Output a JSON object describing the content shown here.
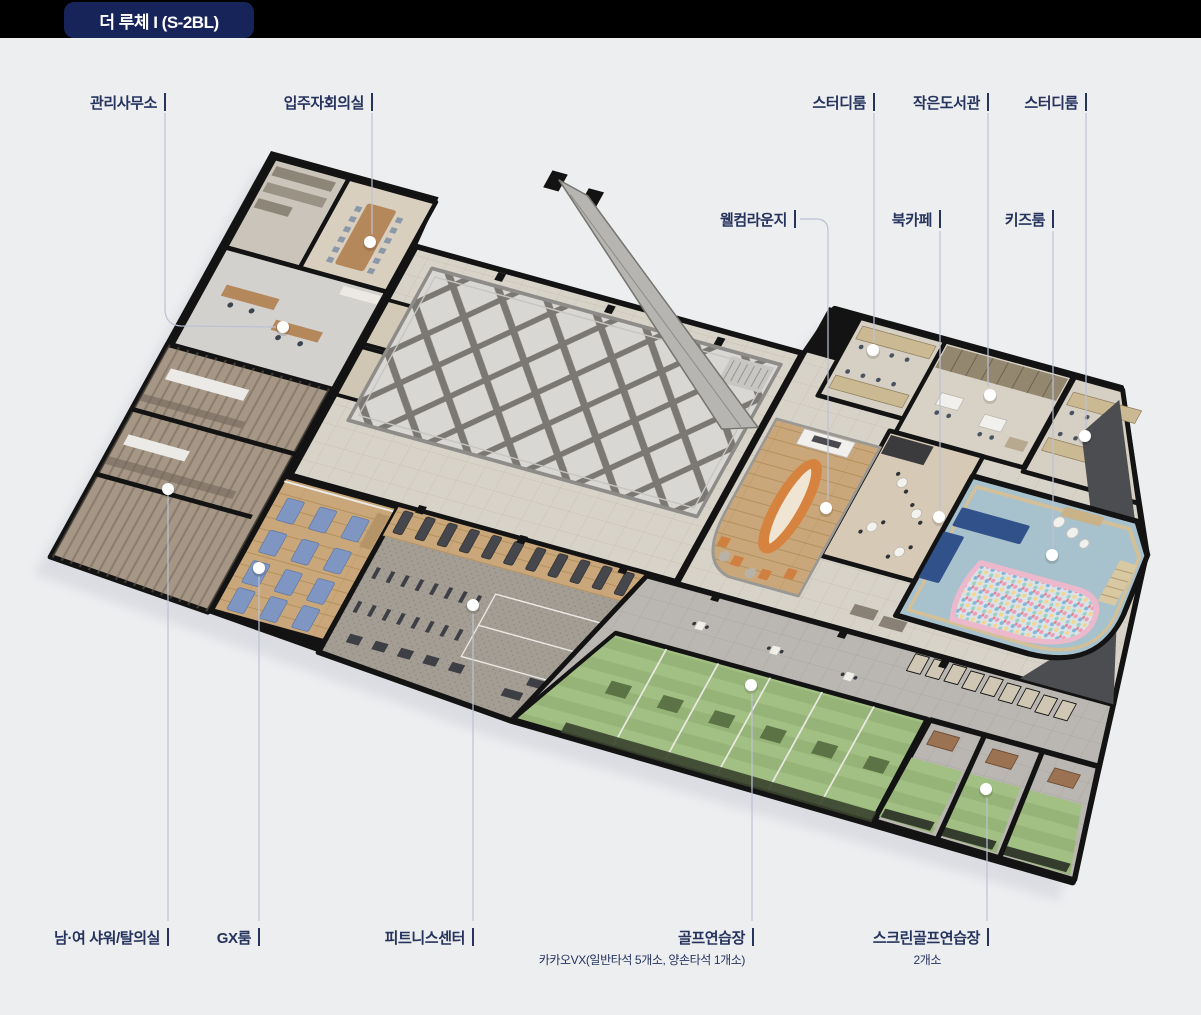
{
  "badge": {
    "title": "더 루체 I (S-2BL)"
  },
  "annotations": [
    {
      "id": "admin-office",
      "label": "관리사무소"
    },
    {
      "id": "meeting-room",
      "label": "입주자회의실"
    },
    {
      "id": "study-room-1",
      "label": "스터디룸"
    },
    {
      "id": "small-library",
      "label": "작은도서관"
    },
    {
      "id": "study-room-2",
      "label": "스터디룸"
    },
    {
      "id": "welcome-lounge",
      "label": "웰컴라운지"
    },
    {
      "id": "book-cafe",
      "label": "북카페"
    },
    {
      "id": "kids-room",
      "label": "키즈룸"
    },
    {
      "id": "shower-locker",
      "label": "남·여 샤워/탈의실"
    },
    {
      "id": "gx-room",
      "label": "GX룸"
    },
    {
      "id": "fitness-center",
      "label": "피트니스센터"
    },
    {
      "id": "golf-range",
      "label": "골프연습장",
      "sub": "카카오VX(일반타석 5개소, 양손타석 1개소)"
    },
    {
      "id": "screen-golf",
      "label": "스크린골프연습장",
      "sub": "2개소"
    }
  ],
  "colors": {
    "badge_navy": "#16245a",
    "label_navy": "#26335d",
    "leader_line": "#bcc2d4",
    "background": "#edeef0",
    "wall_black": "#131313",
    "golf_green": "#97b478",
    "kids_blue": "#a7c1cd",
    "gx_wood": "#c9a77a",
    "lounge_orange": "#d5833f"
  }
}
